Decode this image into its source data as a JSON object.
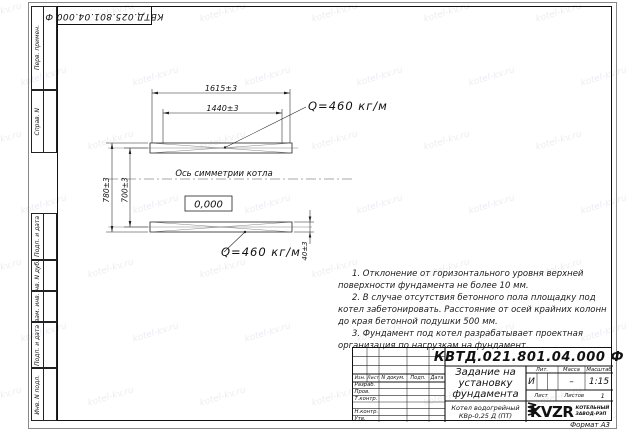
{
  "watermark": {
    "text": "kotel-kv.ru"
  },
  "corner_stamp": {
    "doc_number": "КВТД.025.801.04.000 Ф"
  },
  "margin_labels": {
    "perv_primen": "Перв. примен.",
    "sprav_n": "Справ. N",
    "podp_data_1": "Подп. и дата",
    "inv_dubl": "Инв. N дубл.",
    "vzam_inv": "Взам. инв. N",
    "podp_data_2": "Подп. и дата",
    "inv_podl": "Инв. N подл."
  },
  "drawing": {
    "dim_top_outer": "1615±3",
    "dim_top_inner": "1440±3",
    "load_top": "Q=460 кг/м",
    "load_bottom": "Q=460 кг/м",
    "axis_label": "Ось симметрии котла",
    "level": "0,000",
    "dim_left_outer": "780±3",
    "dim_left_inner": "700±3",
    "dim_right": "40±3"
  },
  "notes": {
    "items": [
      "1. Отклонение от горизонтального уровня верхней поверхности фундамента не более 10 мм.",
      "2. В случае отсутствия бетонного пола площадку под котел забетонировать. Расстояние от осей крайних колонн до края бетонной подушки 500 мм.",
      "3. Фундамент под котел разрабатывает проектная организация по нагрузкам на фундамент."
    ]
  },
  "title_block": {
    "doc_number": "КВТД.021.801.04.000 Ф",
    "title_line1": "Задание на",
    "title_line2": "установку",
    "title_line3": "фундамента",
    "columns": {
      "izm": "Изм.",
      "list": "Лист",
      "n_doc": "N докум.",
      "podp": "Подп.",
      "data": "Дата"
    },
    "rows": {
      "razrab": "Разраб.",
      "prov": "Пров.",
      "t_contr": "Т.контр.",
      "n_contr": "Н.контр.",
      "utv": "Утв."
    },
    "lit_label": "Лит.",
    "lit_value": "И",
    "mass_label": "Масса",
    "mass_value": "–",
    "scale_label": "Масштаб",
    "scale_value": "1:15",
    "sheet_label": "Лист",
    "sheets_label": "Листов",
    "sheets_value": "1",
    "product_line1": "Котел водогрейный",
    "product_line2": "КВр-0,25 Д (ПТ)",
    "company_name": "KVZR",
    "company_sub1": "КОТЕЛЬНЫЙ",
    "company_sub2": "ЗАВОД-РЭП",
    "format": "Формат А3"
  }
}
